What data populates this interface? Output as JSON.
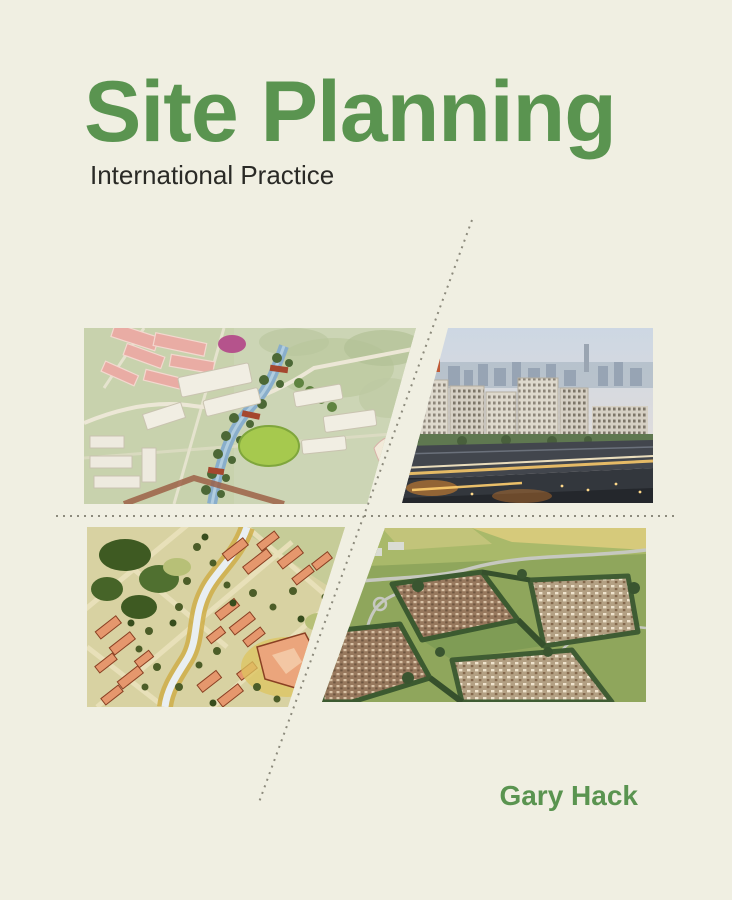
{
  "cover": {
    "title": "Site Planning",
    "subtitle": "International Practice",
    "author": "Gary Hack"
  },
  "colors": {
    "background": "#f0efe2",
    "title_green": "#5a9450",
    "subtitle_dark": "#2a2a26",
    "dotted_line": "#8c8a7c"
  },
  "images": {
    "top_left": {
      "description": "Aerial rendering of a new district masterplan with pink housing blocks, white buildings and a green river corridor"
    },
    "top_right": {
      "description": "Photograph of white modular high-rise buildings above an elevated highway with light trails at dusk"
    },
    "bottom_left": {
      "description": "Hand-drawn watercolor site plan with orange buildings, tree-lined diagonal streets and a winding creek"
    },
    "bottom_right": {
      "description": "Aerial photograph of suburban housing estates bounded by hedgerows, roads and green fields"
    }
  }
}
